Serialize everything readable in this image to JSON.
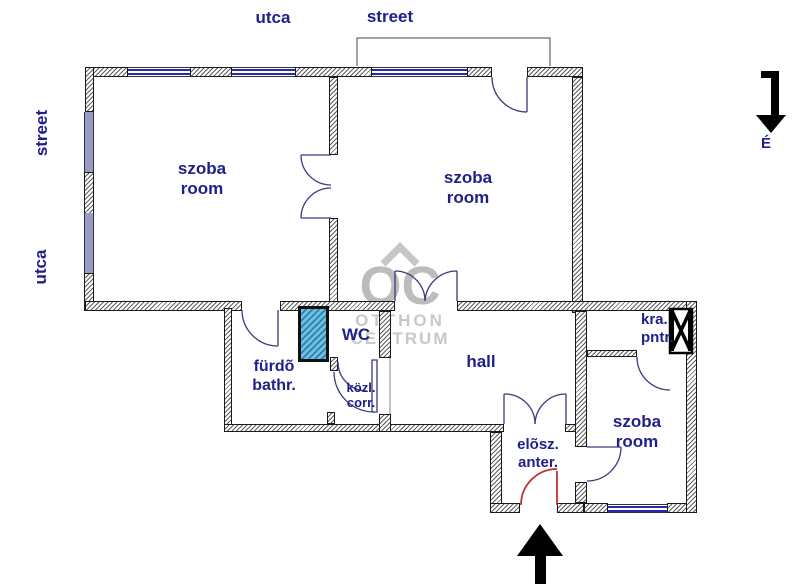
{
  "plan": {
    "street_labels": {
      "top_left": "utca",
      "top_right": "street",
      "side_upper": "street",
      "side_lower": "utca"
    },
    "north_label": "É",
    "rooms": {
      "room1_hu": "szoba",
      "room1_en": "room",
      "room2_hu": "szoba",
      "room2_en": "room",
      "room3_hu": "szoba",
      "room3_en": "room",
      "bath_hu": "fürdõ",
      "bath_en": "bathr.",
      "wc": "WC",
      "corridor_hu": "közl.",
      "corridor_en": "corr.",
      "hall": "hall",
      "anteroom_hu": "elõsz.",
      "anteroom_en": "anter.",
      "pantry_hu": "kra.",
      "pantry_en": "pntr."
    },
    "watermark": {
      "logo": "OC",
      "line1": "OTTHON",
      "line2": "CENTRUM"
    },
    "colors": {
      "label_navy": "#20208c",
      "window_blue": "#2929b0",
      "window_band_lavender": "#9a9ac8",
      "shaft_blue": "#5fb8dc",
      "entrance_door_red": "#c03030",
      "watermark_gray": "#c4c4c4",
      "arrow_black": "#000000"
    }
  }
}
